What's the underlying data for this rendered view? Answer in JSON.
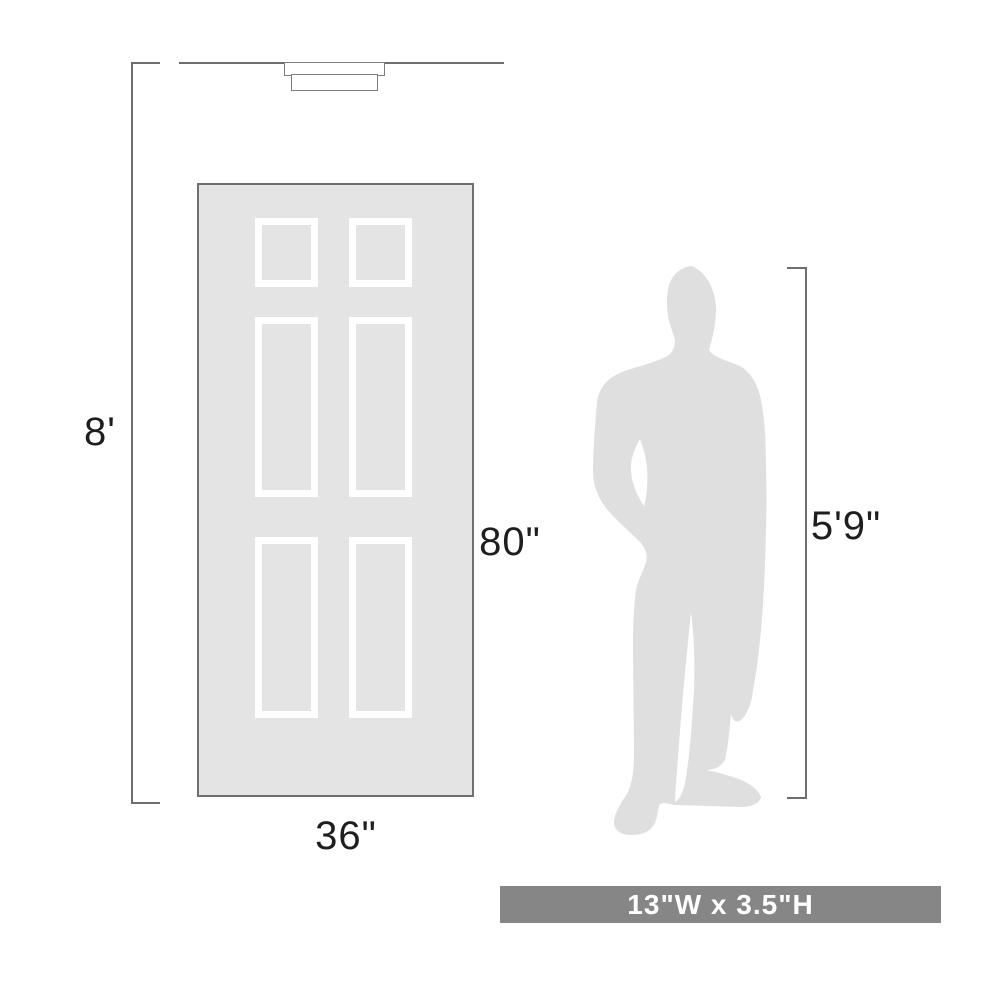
{
  "diagram": {
    "type": "product-scale-diagram",
    "labels": {
      "ceiling_height": "8'",
      "door_height": "80\"",
      "door_width": "36\"",
      "person_height": "5'9\"",
      "fixture_size": "13\"W x 3.5\"H"
    },
    "elements": {
      "fixture": "flush-mount-ceiling-light",
      "door": "six-panel-door",
      "person": "man-silhouette"
    }
  },
  "colors": {
    "line": "#6e6e6e",
    "door_fill": "#e4e4e4",
    "door_border": "#6f6f6f",
    "panel_frame": "#ffffff",
    "silhouette": "#dfdfdf",
    "size_bar_bg": "#868686",
    "size_bar_text": "#ffffff",
    "label_text": "#1e1e1e",
    "background": "#ffffff"
  }
}
